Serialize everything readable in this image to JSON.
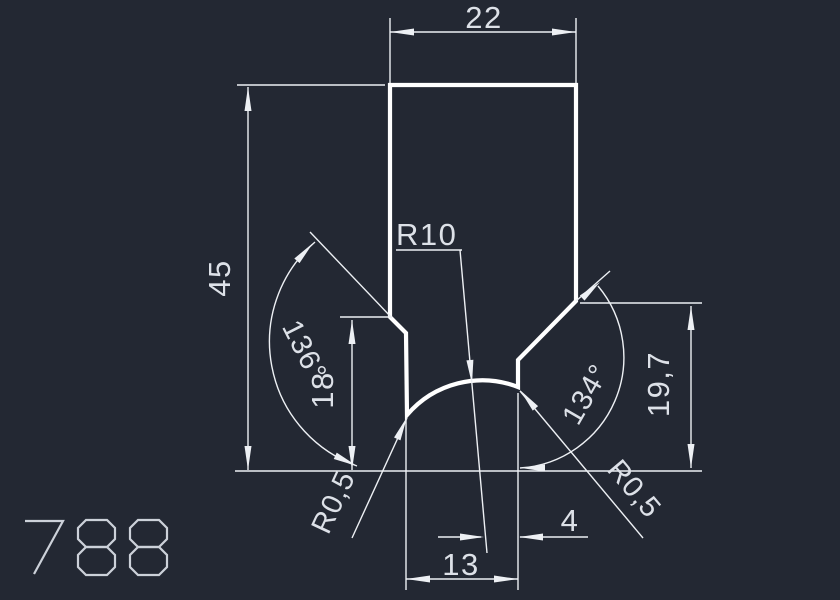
{
  "app": {
    "background_color": "#232833",
    "outline_color": "#ffffff",
    "dimension_color": "#edf0f4",
    "text_color": "#dde1e8"
  },
  "drawing": {
    "part_number": "788",
    "dims": {
      "top_width": "22",
      "overall_height": "45",
      "left_step_height": "18",
      "right_step_height": "19,7",
      "left_angle": "136°",
      "right_angle": "134°",
      "arc_radius": "R10",
      "fillet_left": "R0,5",
      "fillet_right": "R0,5",
      "apex_offset": "4",
      "bottom_width": "13"
    }
  }
}
